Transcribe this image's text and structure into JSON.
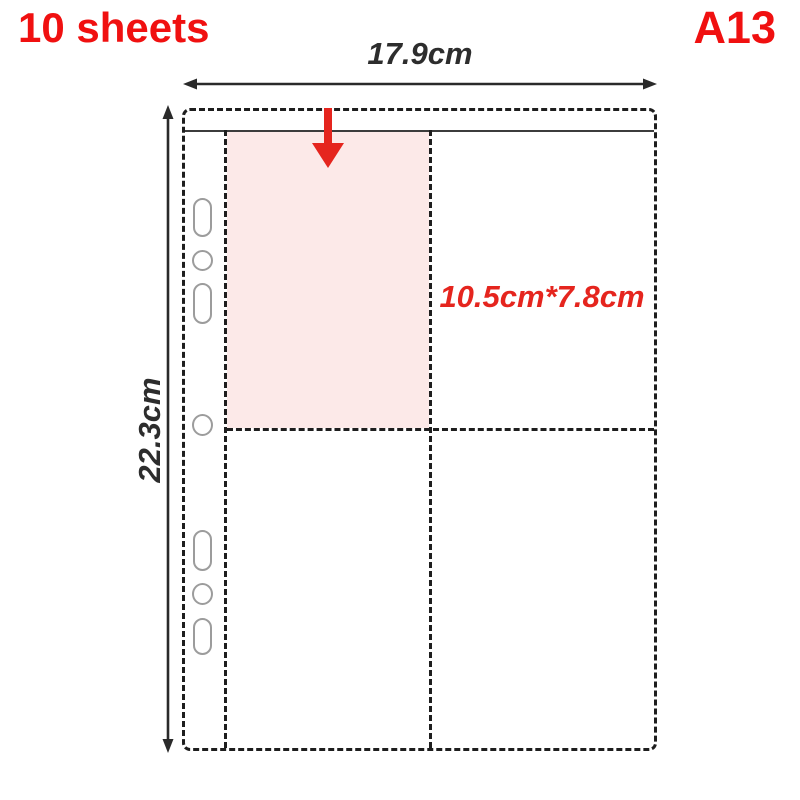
{
  "product_label": {
    "sheet_count": "10 sheets",
    "model_code": "A13"
  },
  "dimensions": {
    "page_width": "17.9cm",
    "page_height": "22.3cm",
    "pocket_size": "10.5cm*7.8cm"
  },
  "diagram": {
    "pockets_visible": 4,
    "binder_holes_visible": 7
  },
  "colors": {
    "accent_red": "#f01010",
    "arrow_red": "#e5251e",
    "pocket_highlight_pink": "#fce9e8",
    "outline_dark": "#1e1e1e",
    "hole_outline_gray": "#9c9c9c",
    "background": "#ffffff"
  },
  "icons": {
    "width_measure_arrow": "double-headed-horizontal-arrow",
    "height_measure_arrow": "double-headed-vertical-arrow",
    "insert_direction_arrow": "red-down-arrow",
    "binder_hole": "punched-hole-outline"
  }
}
